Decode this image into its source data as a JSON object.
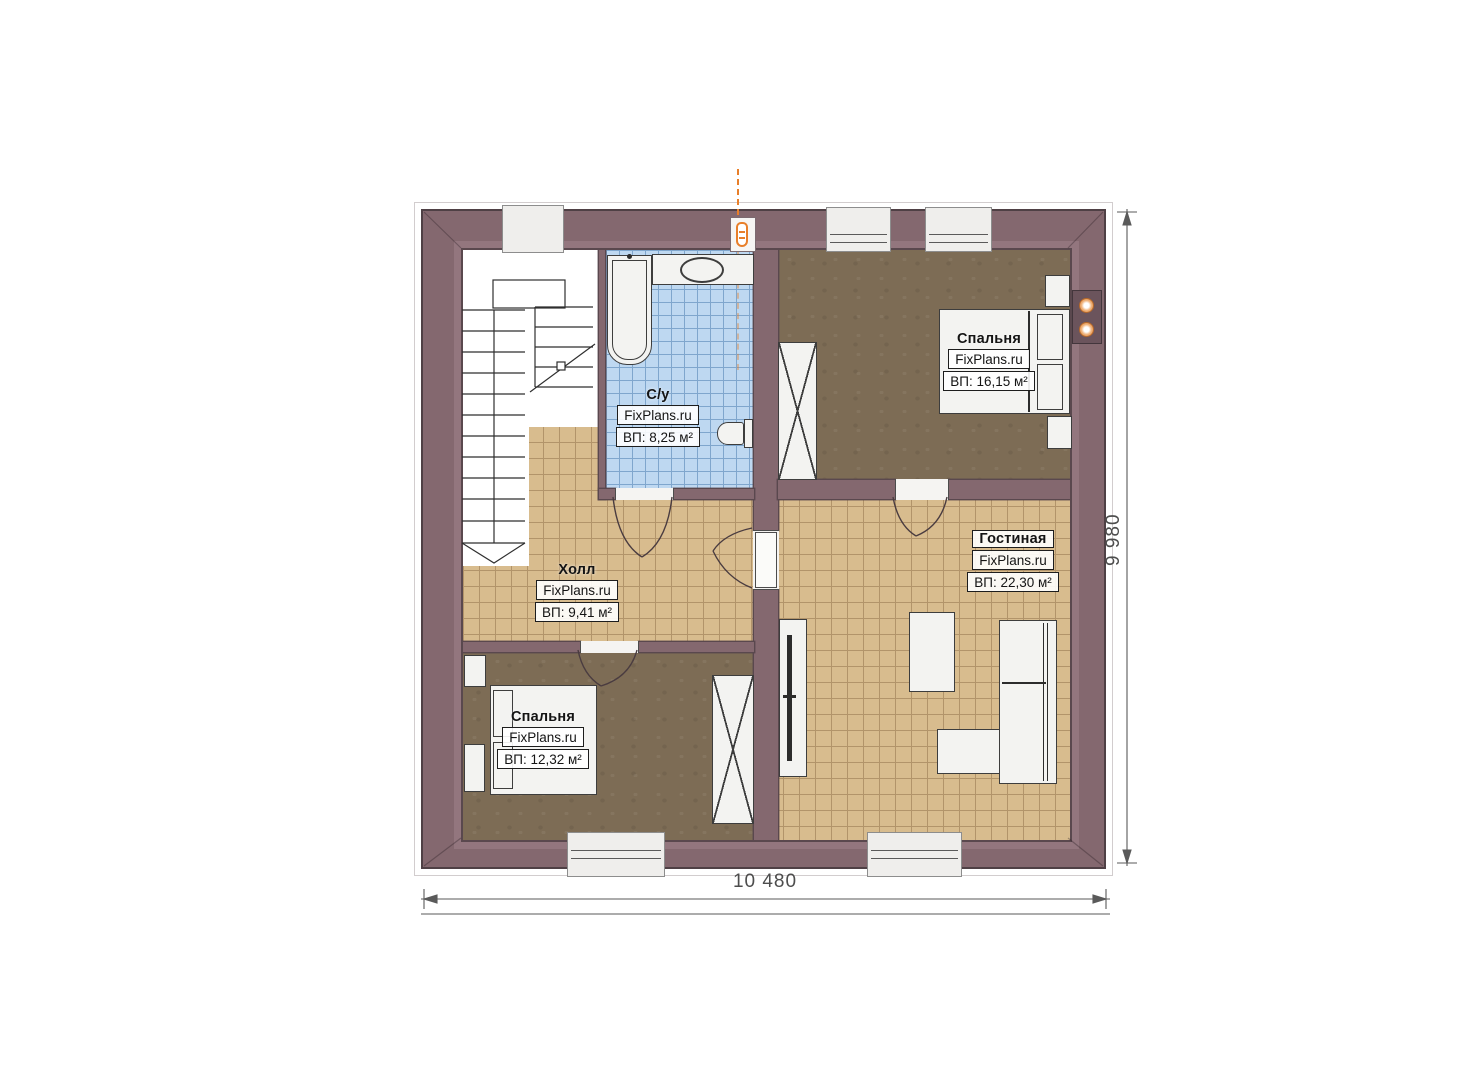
{
  "watermark": "FixPlans.ru",
  "rooms": {
    "bathroom": {
      "name": "С/у",
      "area": "ВП: 8,25 м²"
    },
    "bedroom_top": {
      "name": "Спальня",
      "area": "ВП: 16,15 м²"
    },
    "living_room": {
      "name": "Гостиная",
      "area": "ВП: 22,30 м²"
    },
    "hall": {
      "name": "Холл",
      "area": "ВП: 9,41 м²"
    },
    "bedroom_bottom": {
      "name": "Спальня",
      "area": "ВП: 12,32 м²"
    }
  },
  "dimensions": {
    "width_label": "10 480",
    "height_label": "9 980"
  },
  "colors": {
    "wall": "#84686f",
    "wall_outline": "#4f4045",
    "tile_beige": "#d8bc8e",
    "tile_blue": "#bed8f1",
    "floor_brown": "#7d6c55",
    "accent_orange": "#e87f2a"
  }
}
